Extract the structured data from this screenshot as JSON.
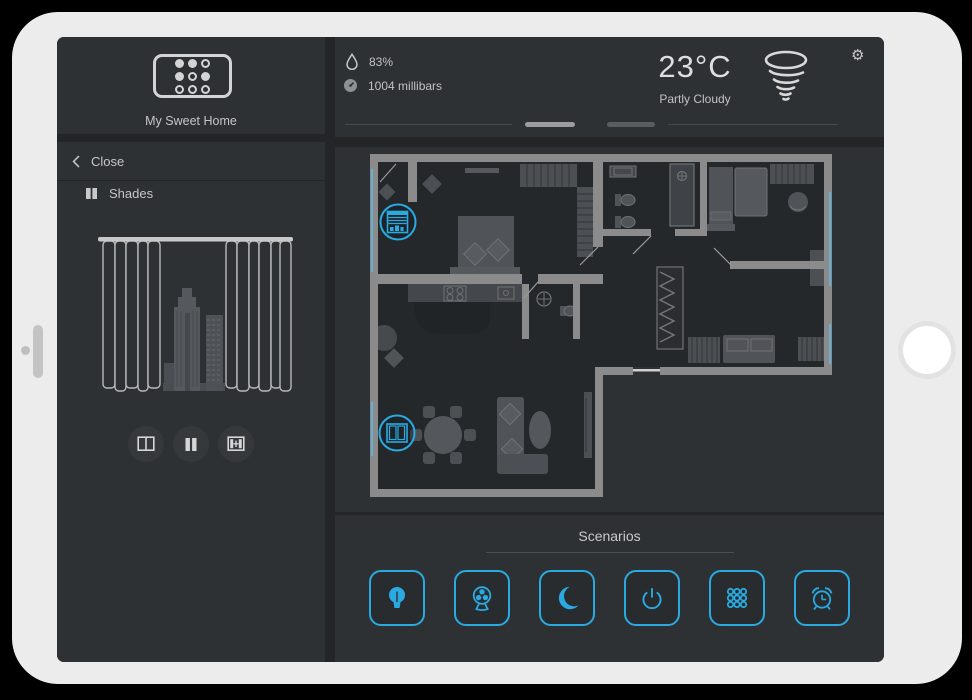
{
  "colors": {
    "accent": "#29abe2",
    "window_blue": "#5fb7e3",
    "panel": "#2e3134",
    "wall": "#8b8b8b"
  },
  "sidebar": {
    "app_name": "My Sweet Home",
    "close_label": "Close",
    "device_label": "Shades",
    "controls": [
      {
        "name": "open-curtains",
        "icon": "curtains-open-icon"
      },
      {
        "name": "pause",
        "icon": "pause-icon"
      },
      {
        "name": "close-curtains",
        "icon": "curtains-close-icon"
      }
    ]
  },
  "header": {
    "humidity": {
      "icon": "droplet-icon",
      "value": "83%"
    },
    "pressure": {
      "icon": "barometer-icon",
      "value": "1004 millibars"
    },
    "temperature": "23°C",
    "condition": "Partly Cloudy",
    "weather_icon": "tornado-icon",
    "settings_glyph": "⚙"
  },
  "floorplan": {
    "overlays": [
      {
        "name": "roller-shade",
        "icon": "roller-shade-icon"
      },
      {
        "name": "curtains",
        "icon": "curtains-icon"
      }
    ]
  },
  "scenarios": {
    "title": "Scenarios",
    "buttons": [
      {
        "name": "lights",
        "icon": "lightbulb-icon",
        "active": true
      },
      {
        "name": "fan",
        "icon": "fan-icon",
        "active": false
      },
      {
        "name": "night",
        "icon": "moon-icon",
        "active": true
      },
      {
        "name": "power",
        "icon": "power-icon",
        "active": false
      },
      {
        "name": "remote",
        "icon": "keypad-icon",
        "active": false
      },
      {
        "name": "alarm",
        "icon": "alarm-clock-icon",
        "active": false
      }
    ]
  }
}
